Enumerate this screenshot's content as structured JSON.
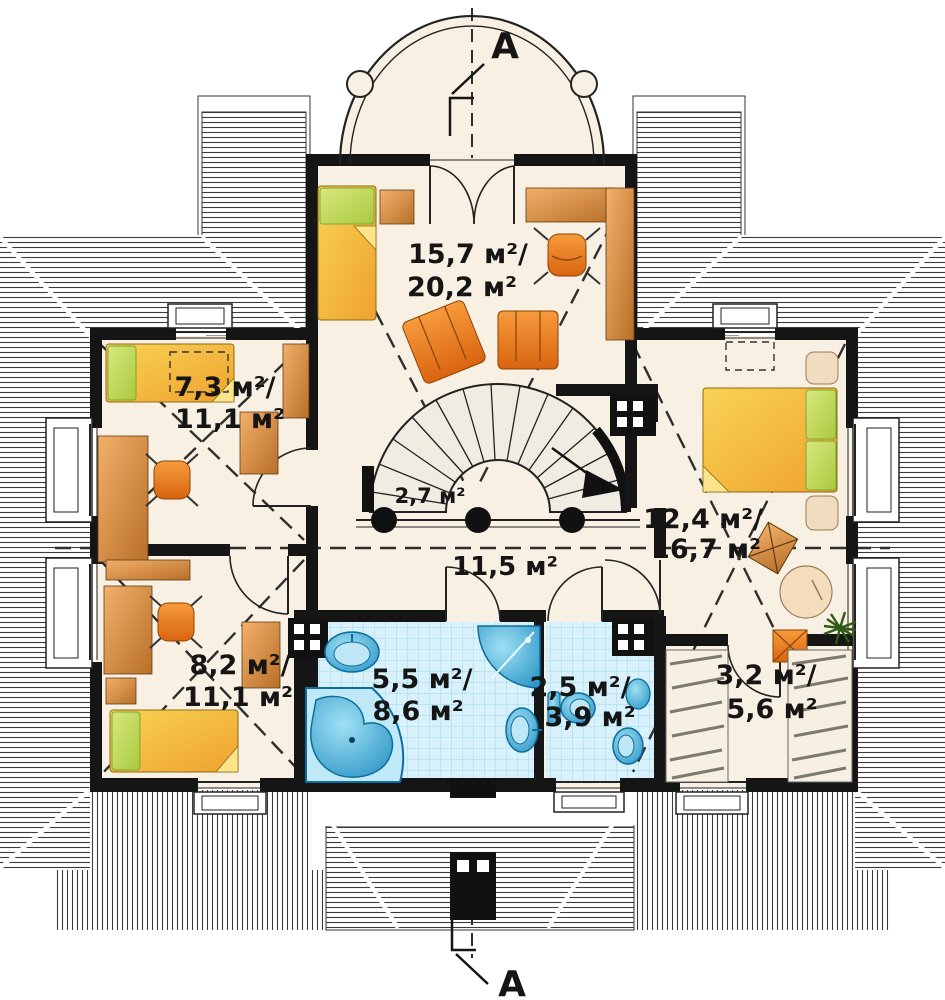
{
  "plan": {
    "type": "floor-plan-attic-level",
    "section_marker": "A",
    "units": "м²",
    "rooms": [
      {
        "name": "bedroom-top",
        "area_line1": "15,7 м²/",
        "area_line2": "20,2 м²"
      },
      {
        "name": "bedroom-left-upper",
        "area_line1": "7,3 м²/",
        "area_line2": "11,1 м²"
      },
      {
        "name": "stairs",
        "area_line1": "2,7 м²",
        "area_line2": ""
      },
      {
        "name": "hall",
        "area_line1": "11,5 м²",
        "area_line2": ""
      },
      {
        "name": "bedroom-right",
        "area_line1": "12,4 м²/",
        "area_line2": "16,7 м²"
      },
      {
        "name": "bedroom-left-lower",
        "area_line1": "8,2 м²/",
        "area_line2": "11,1 м²"
      },
      {
        "name": "bathroom",
        "area_line1": "5,5 м²/",
        "area_line2": "8,6 м²"
      },
      {
        "name": "wc",
        "area_line1": "2,5 м²/",
        "area_line2": "3,9 м²"
      },
      {
        "name": "wardrobe",
        "area_line1": "3,2 м²/",
        "area_line2": "5,6 м²"
      }
    ],
    "colors": {
      "floor": "#f8f1e3",
      "wall": "#151515",
      "bed_yellow": "#f6c544",
      "pillow_green": "#c3dc66",
      "furniture_wood": "#e8913f",
      "chair_orange": "#ee7d1f",
      "fixture_blue": "#45b7de",
      "tile_blue": "#d9f1fa",
      "roof_hatch": "#3c3c3c"
    }
  }
}
